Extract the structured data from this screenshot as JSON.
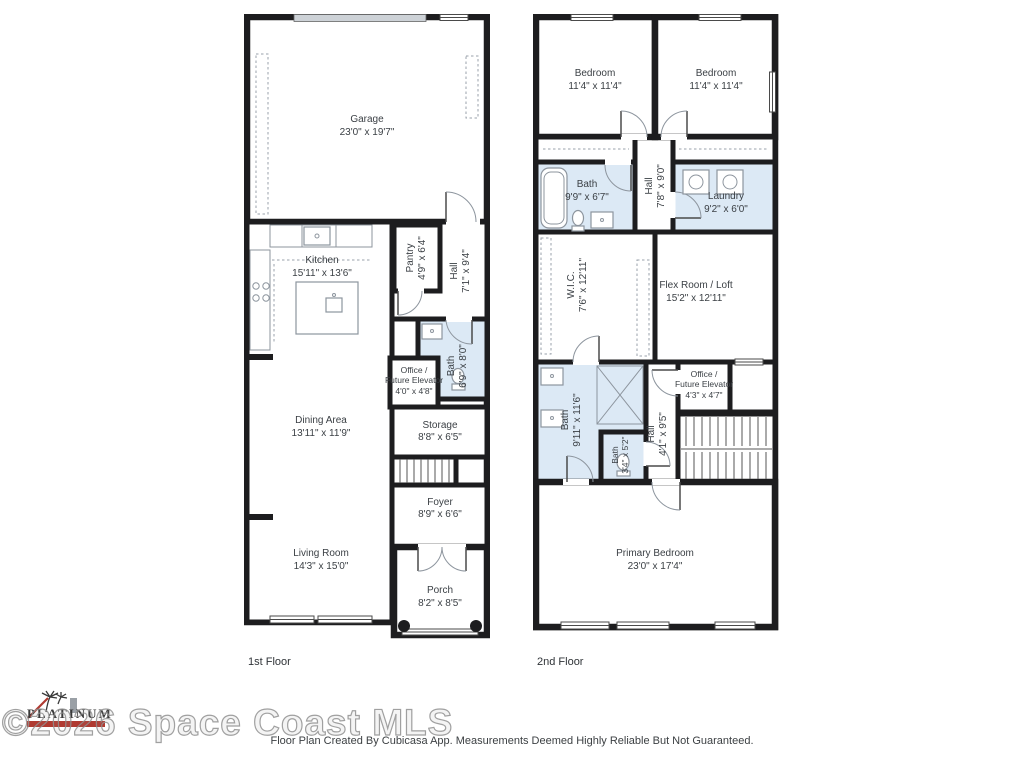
{
  "colors": {
    "wall": "#1d1d1f",
    "wet_room": "#dce9f5",
    "fixture": "#8d959e"
  },
  "footer": {
    "disclaimer": "Floor Plan Created By Cubicasa App. Measurements Deemed Highly Reliable But Not Guaranteed."
  },
  "watermark": {
    "text": "©2026 Space Coast MLS",
    "logo_text": "PLATINUM"
  },
  "floor1": {
    "label": "1st Floor",
    "rooms": {
      "garage": {
        "name": "Garage",
        "dims": "23'0\" x 19'7\""
      },
      "kitchen": {
        "name": "Kitchen",
        "dims": "15'11\" x 13'6\""
      },
      "pantry": {
        "name": "Pantry",
        "dims": "4'9\" x 6'4\""
      },
      "hall": {
        "name": "Hall",
        "dims": "7'1\" x 9'4\""
      },
      "bath": {
        "name": "Bath",
        "dims": "6'9\" x 8'0\""
      },
      "office": {
        "name1": "Office /",
        "name2": "Future Elevator",
        "dims": "4'0\" x 4'8\""
      },
      "dining": {
        "name": "Dining Area",
        "dims": "13'11\" x 11'9\""
      },
      "storage": {
        "name": "Storage",
        "dims": "8'8\" x 6'5\""
      },
      "foyer": {
        "name": "Foyer",
        "dims": "8'9\" x 6'6\""
      },
      "living": {
        "name": "Living Room",
        "dims": "14'3\" x 15'0\""
      },
      "porch": {
        "name": "Porch",
        "dims": "8'2\" x 8'5\""
      }
    }
  },
  "floor2": {
    "label": "2nd Floor",
    "rooms": {
      "bedroom_left": {
        "name": "Bedroom",
        "dims": "11'4\" x 11'4\""
      },
      "bedroom_right": {
        "name": "Bedroom",
        "dims": "11'4\" x 11'4\""
      },
      "bath_upper": {
        "name": "Bath",
        "dims": "9'9\" x 6'7\""
      },
      "hall_upper": {
        "name": "Hall",
        "dims": "7'8\" x 9'0\""
      },
      "laundry": {
        "name": "Laundry",
        "dims": "9'2\" x 6'0\""
      },
      "wic": {
        "name": "W.I.C.",
        "dims": "7'6\" x 12'11\""
      },
      "flex": {
        "name": "Flex Room / Loft",
        "dims": "15'2\" x 12'11\""
      },
      "bath_primary": {
        "name": "Bath",
        "dims": "9'11\" x 11'6\""
      },
      "bath_toilet": {
        "name": "Bath",
        "dims": "3'4\" x 5'2\""
      },
      "hall_mid": {
        "name": "Hall",
        "dims": "4'1\" x 9'5\""
      },
      "office": {
        "name1": "Office /",
        "name2": "Future Elevator",
        "dims": "4'3\" x 4'7\""
      },
      "primary": {
        "name": "Primary Bedroom",
        "dims": "23'0\" x 17'4\""
      }
    }
  }
}
